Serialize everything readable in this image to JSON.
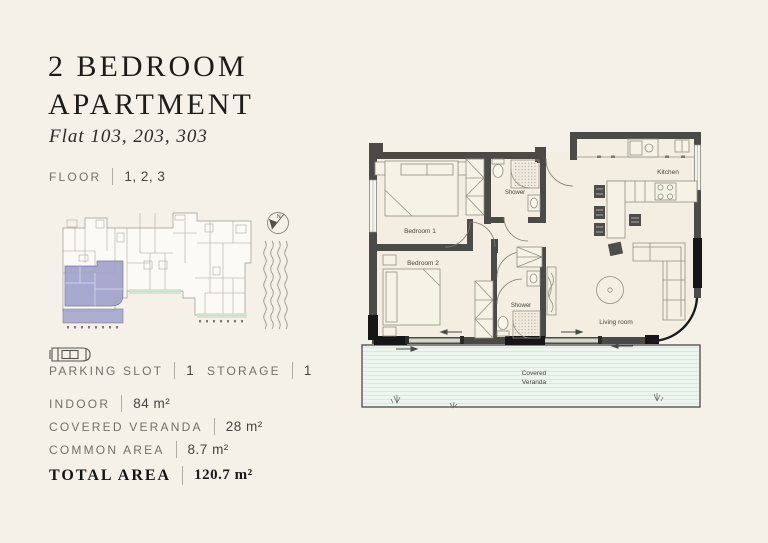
{
  "header": {
    "title_line1": "2 BEDROOM",
    "title_line2": "APARTMENT",
    "subtitle": "Flat 103, 203, 303"
  },
  "specs": {
    "floor": {
      "label": "FLOOR",
      "value": "1, 2, 3"
    },
    "parking": {
      "label": "PARKING SLOT",
      "value": "1"
    },
    "storage": {
      "label": "STORAGE",
      "value": "1"
    },
    "indoor": {
      "label": "INDOOR",
      "value": "84 m²"
    },
    "covered_veranda": {
      "label": "COVERED VERANDA",
      "value": "28 m²"
    },
    "common_area": {
      "label": "COMMON AREA",
      "value": "8.7 m²"
    },
    "total": {
      "label": "TOTAL AREA",
      "value": "120.7  m²"
    }
  },
  "floorplan": {
    "labels": {
      "bedroom1": "Bedroom 1",
      "bedroom2": "Bedroom 2",
      "shower_top": "Shower",
      "shower_bottom": "Shower",
      "kitchen": "Kitchen",
      "living_room": "Living room",
      "veranda_line1": "Covered",
      "veranda_line2": "Veranda"
    }
  },
  "colors": {
    "background": "#f5f1e9",
    "wall": "#4b4a46",
    "floor_fill": "#f3eee1",
    "veranda_green": "#edf6ee",
    "highlight_purple": "#a0a3cc"
  }
}
